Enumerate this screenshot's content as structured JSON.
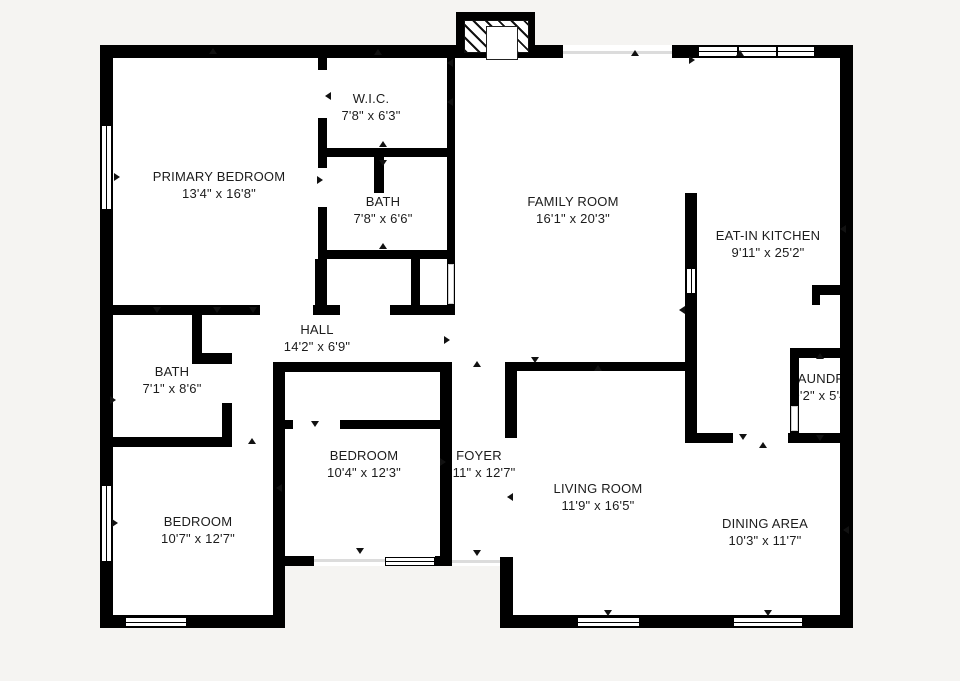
{
  "canvas": {
    "width": 960,
    "height": 681,
    "background": "#f5f4f2",
    "wall_color": "#000000",
    "floor_color": "#ffffff",
    "accent_text_color": "#1c1c1c"
  },
  "rooms": [
    {
      "name": "W.I.C.",
      "dims": "7'8\" x 6'3\"",
      "cx": 371,
      "cy": 107
    },
    {
      "name": "PRIMARY BEDROOM",
      "dims": "13'4\" x 16'8\"",
      "cx": 219,
      "cy": 185
    },
    {
      "name": "BATH",
      "dims": "7'8\" x 6'6\"",
      "cx": 383,
      "cy": 210
    },
    {
      "name": "FAMILY ROOM",
      "dims": "16'1\" x 20'3\"",
      "cx": 573,
      "cy": 210
    },
    {
      "name": "EAT-IN KITCHEN",
      "dims": "9'11\" x 25'2\"",
      "cx": 768,
      "cy": 244
    },
    {
      "name": "HALL",
      "dims": "14'2\" x 6'9\"",
      "cx": 317,
      "cy": 338
    },
    {
      "name": "BATH",
      "dims": "7'1\" x 8'6\"",
      "cx": 172,
      "cy": 380
    },
    {
      "name": "LAUNDRY",
      "dims": "9'2\" x 5'4\"",
      "cx": 822,
      "cy": 387
    },
    {
      "name": "BEDROOM",
      "dims": "10'4\" x 12'3\"",
      "cx": 364,
      "cy": 464
    },
    {
      "name": "FOYER",
      "dims": "3'11\" x 12'7\"",
      "cx": 479,
      "cy": 464
    },
    {
      "name": "LIVING ROOM",
      "dims": "11'9\" x 16'5\"",
      "cx": 598,
      "cy": 497
    },
    {
      "name": "BEDROOM",
      "dims": "10'7\" x 12'7\"",
      "cx": 198,
      "cy": 530
    },
    {
      "name": "DINING AREA",
      "dims": "10'3\" x 11'7\"",
      "cx": 765,
      "cy": 532
    }
  ],
  "floors": [
    [
      100,
      45,
      753,
      521
    ],
    [
      100,
      566,
      185,
      62
    ],
    [
      500,
      566,
      353,
      62
    ]
  ],
  "walls": [
    [
      100,
      45,
      13,
      583
    ],
    [
      100,
      45,
      463,
      13
    ],
    [
      672,
      45,
      181,
      13
    ],
    [
      840,
      45,
      13,
      583
    ],
    [
      100,
      615,
      185,
      13
    ],
    [
      500,
      615,
      353,
      13
    ],
    [
      318,
      58,
      9,
      12
    ],
    [
      318,
      118,
      9,
      50
    ],
    [
      318,
      207,
      9,
      108
    ],
    [
      326,
      148,
      121,
      9
    ],
    [
      374,
      148,
      10,
      45
    ],
    [
      447,
      58,
      8,
      247
    ],
    [
      326,
      250,
      121,
      9
    ],
    [
      315,
      259,
      9,
      56
    ],
    [
      411,
      250,
      9,
      65
    ],
    [
      100,
      305,
      160,
      10
    ],
    [
      313,
      305,
      27,
      10
    ],
    [
      390,
      305,
      65,
      10
    ],
    [
      273,
      362,
      175,
      10
    ],
    [
      507,
      362,
      181,
      9
    ],
    [
      192,
      315,
      10,
      42
    ],
    [
      192,
      353,
      40,
      11
    ],
    [
      222,
      403,
      10,
      44
    ],
    [
      100,
      437,
      132,
      10
    ],
    [
      273,
      362,
      12,
      253
    ],
    [
      285,
      420,
      8,
      9
    ],
    [
      340,
      420,
      110,
      9
    ],
    [
      440,
      362,
      12,
      204
    ],
    [
      280,
      556,
      34,
      10
    ],
    [
      435,
      556,
      17,
      10
    ],
    [
      505,
      362,
      12,
      76
    ],
    [
      500,
      557,
      13,
      71
    ],
    [
      685,
      193,
      12,
      250
    ],
    [
      688,
      433,
      45,
      10
    ],
    [
      790,
      348,
      53,
      10
    ],
    [
      790,
      348,
      9,
      95
    ],
    [
      788,
      433,
      55,
      10
    ],
    [
      812,
      285,
      31,
      10
    ],
    [
      812,
      285,
      8,
      20
    ]
  ],
  "windows": [
    {
      "x": 698,
      "y": 46,
      "w": 117,
      "h": 11,
      "orient": "h"
    },
    {
      "x": 101,
      "y": 125,
      "w": 11,
      "h": 85,
      "orient": "v"
    },
    {
      "x": 101,
      "y": 485,
      "w": 11,
      "h": 77,
      "orient": "v"
    },
    {
      "x": 125,
      "y": 617,
      "w": 62,
      "h": 10,
      "orient": "h"
    },
    {
      "x": 577,
      "y": 617,
      "w": 63,
      "h": 10,
      "orient": "h"
    },
    {
      "x": 733,
      "y": 617,
      "w": 70,
      "h": 10,
      "orient": "h"
    },
    {
      "x": 385,
      "y": 557,
      "w": 50,
      "h": 9,
      "orient": "h"
    },
    {
      "x": 686,
      "y": 268,
      "w": 10,
      "h": 26,
      "orient": "v"
    }
  ],
  "door_openings": [
    {
      "x": 448,
      "y": 264,
      "w": 6,
      "h": 40
    },
    {
      "x": 791,
      "y": 406,
      "w": 7,
      "h": 25
    }
  ],
  "faint_openings": [
    {
      "x": 563,
      "y": 51,
      "w": 109,
      "h": 3
    },
    {
      "x": 452,
      "y": 560,
      "w": 48,
      "h": 3
    },
    {
      "x": 313,
      "y": 559,
      "w": 72,
      "h": 3
    }
  ],
  "chimney": {
    "frame": [
      456,
      12,
      79,
      46
    ],
    "hatch": [
      464,
      20,
      63,
      31
    ],
    "box": [
      486,
      26,
      30,
      32
    ]
  },
  "markers": [
    {
      "x": 213,
      "y": 51,
      "dir": "up"
    },
    {
      "x": 378,
      "y": 52,
      "dir": "up"
    },
    {
      "x": 635,
      "y": 53,
      "dir": "up"
    },
    {
      "x": 740,
      "y": 53,
      "dir": "up"
    },
    {
      "x": 383,
      "y": 144,
      "dir": "up"
    },
    {
      "x": 477,
      "y": 364,
      "dir": "up"
    },
    {
      "x": 598,
      "y": 368,
      "dir": "up"
    },
    {
      "x": 383,
      "y": 246,
      "dir": "up"
    },
    {
      "x": 763,
      "y": 445,
      "dir": "up"
    },
    {
      "x": 820,
      "y": 356,
      "dir": "up"
    },
    {
      "x": 252,
      "y": 441,
      "dir": "up"
    },
    {
      "x": 383,
      "y": 163,
      "dir": "down"
    },
    {
      "x": 157,
      "y": 310,
      "dir": "down"
    },
    {
      "x": 217,
      "y": 310,
      "dir": "down"
    },
    {
      "x": 253,
      "y": 310,
      "dir": "down"
    },
    {
      "x": 535,
      "y": 360,
      "dir": "down"
    },
    {
      "x": 360,
      "y": 551,
      "dir": "down"
    },
    {
      "x": 477,
      "y": 553,
      "dir": "down"
    },
    {
      "x": 608,
      "y": 613,
      "dir": "down"
    },
    {
      "x": 768,
      "y": 613,
      "dir": "down"
    },
    {
      "x": 820,
      "y": 438,
      "dir": "down"
    },
    {
      "x": 743,
      "y": 437,
      "dir": "down"
    },
    {
      "x": 315,
      "y": 424,
      "dir": "down"
    },
    {
      "x": 328,
      "y": 96,
      "dir": "left"
    },
    {
      "x": 450,
      "y": 63,
      "dir": "left"
    },
    {
      "x": 450,
      "y": 102,
      "dir": "left"
    },
    {
      "x": 843,
      "y": 229,
      "dir": "left"
    },
    {
      "x": 846,
      "y": 530,
      "dir": "left"
    },
    {
      "x": 510,
      "y": 497,
      "dir": "left"
    },
    {
      "x": 682,
      "y": 310,
      "dir": "left"
    },
    {
      "x": 279,
      "y": 488,
      "dir": "left"
    },
    {
      "x": 117,
      "y": 177,
      "dir": "right"
    },
    {
      "x": 320,
      "y": 180,
      "dir": "right"
    },
    {
      "x": 115,
      "y": 523,
      "dir": "right"
    },
    {
      "x": 447,
      "y": 340,
      "dir": "right"
    },
    {
      "x": 443,
      "y": 462,
      "dir": "right"
    },
    {
      "x": 113,
      "y": 400,
      "dir": "right"
    },
    {
      "x": 692,
      "y": 60,
      "dir": "right"
    }
  ]
}
